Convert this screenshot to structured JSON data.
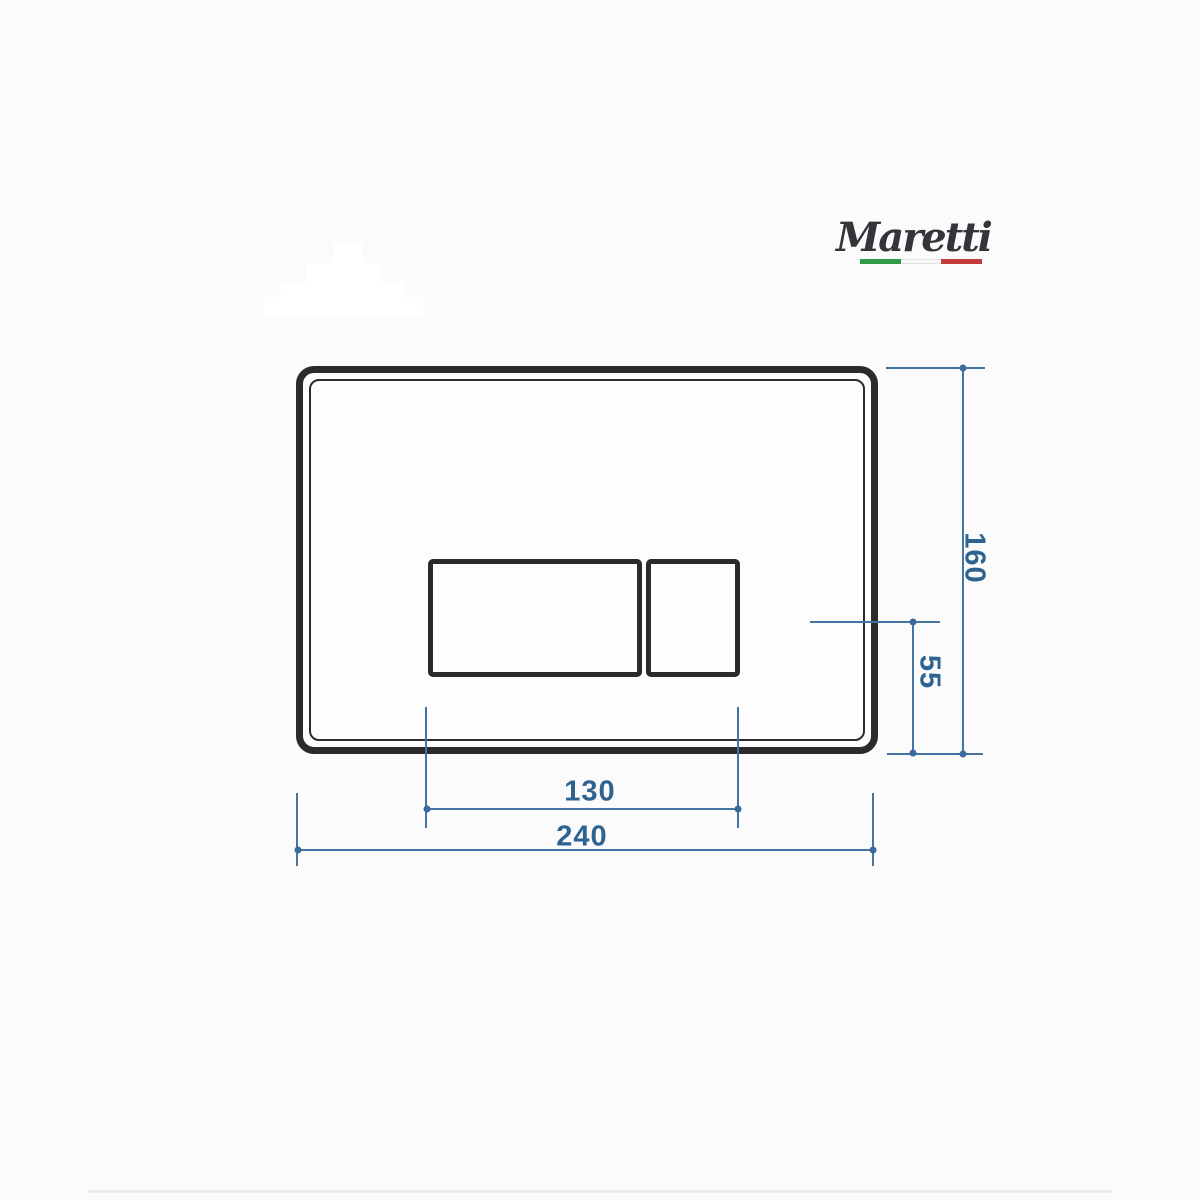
{
  "brand": {
    "name": "Maretti"
  },
  "drawing": {
    "dimensions": {
      "plate_width": "240",
      "plate_height": "160",
      "buttons_width": "130",
      "buttons_offset": "55"
    }
  },
  "colors": {
    "canvas_bg": "#fbfbfb",
    "plate_stroke": "#2b2b2e",
    "dim_line": "#4474a1",
    "dim_text": "#2d6390",
    "dim_dot": "#3a6b9c",
    "logo_ink": "#33353a",
    "flag_green": "#2f9a47",
    "flag_white": "#f7f7f7",
    "flag_red": "#c23b3b",
    "separator": "#ececec",
    "watermark": "#ffffff"
  }
}
